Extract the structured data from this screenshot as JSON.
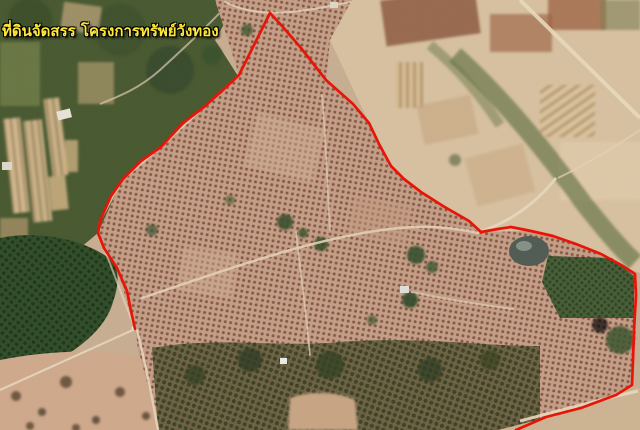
{
  "window": {
    "width": 640,
    "height": 430,
    "kind": "satellite-map-view"
  },
  "map": {
    "label": {
      "text": "ที่ดินจัดสรร โครงการทรัพย์วังทอง",
      "color": "#ffe83c",
      "outline_color": "#000000"
    },
    "boundary": {
      "color": "#e81408",
      "stroke_width": 2.7,
      "closed": false,
      "points": [
        [
          135,
          329
        ],
        [
          131,
          311
        ],
        [
          127,
          291
        ],
        [
          117,
          268
        ],
        [
          104,
          248
        ],
        [
          98,
          233
        ],
        [
          100,
          221
        ],
        [
          111,
          196
        ],
        [
          123,
          179
        ],
        [
          141,
          161
        ],
        [
          161,
          147
        ],
        [
          183,
          123
        ],
        [
          204,
          107
        ],
        [
          223,
          90
        ],
        [
          239,
          75
        ],
        [
          270,
          13
        ],
        [
          282,
          26
        ],
        [
          301,
          48
        ],
        [
          326,
          80
        ],
        [
          353,
          104
        ],
        [
          369,
          123
        ],
        [
          379,
          144
        ],
        [
          391,
          166
        ],
        [
          404,
          179
        ],
        [
          421,
          192
        ],
        [
          443,
          206
        ],
        [
          469,
          221
        ],
        [
          481,
          232
        ],
        [
          498,
          229
        ],
        [
          511,
          227
        ],
        [
          531,
          231
        ],
        [
          553,
          236
        ],
        [
          576,
          244
        ],
        [
          601,
          254
        ],
        [
          623,
          266
        ],
        [
          635,
          274
        ],
        [
          636,
          295
        ],
        [
          634,
          330
        ],
        [
          633,
          360
        ],
        [
          632,
          385
        ],
        [
          616,
          395
        ],
        [
          581,
          408
        ],
        [
          546,
          417
        ],
        [
          516,
          430
        ]
      ]
    },
    "features": [
      "orchard-tree-grid",
      "left-forest-patch",
      "top-left-strip-fields",
      "top-right-field-mosaic",
      "pond",
      "dark-green-orchard",
      "dirt-roads",
      "farm-buildings",
      "bottom-tree-band",
      "bare-soil-fields"
    ],
    "palette": {
      "base_tan": "#c8ae92",
      "orchard_base": "#c49e87",
      "orchard_dot": "#7b4a39",
      "forest_green": "#2f4c28",
      "green_zone": "#47582f",
      "dark_band": "#68603f",
      "pond": "#4f5b53",
      "road": "#e8d8bd",
      "field_light": "#d7c1a1",
      "field_brown": "#8d5a3f"
    }
  }
}
